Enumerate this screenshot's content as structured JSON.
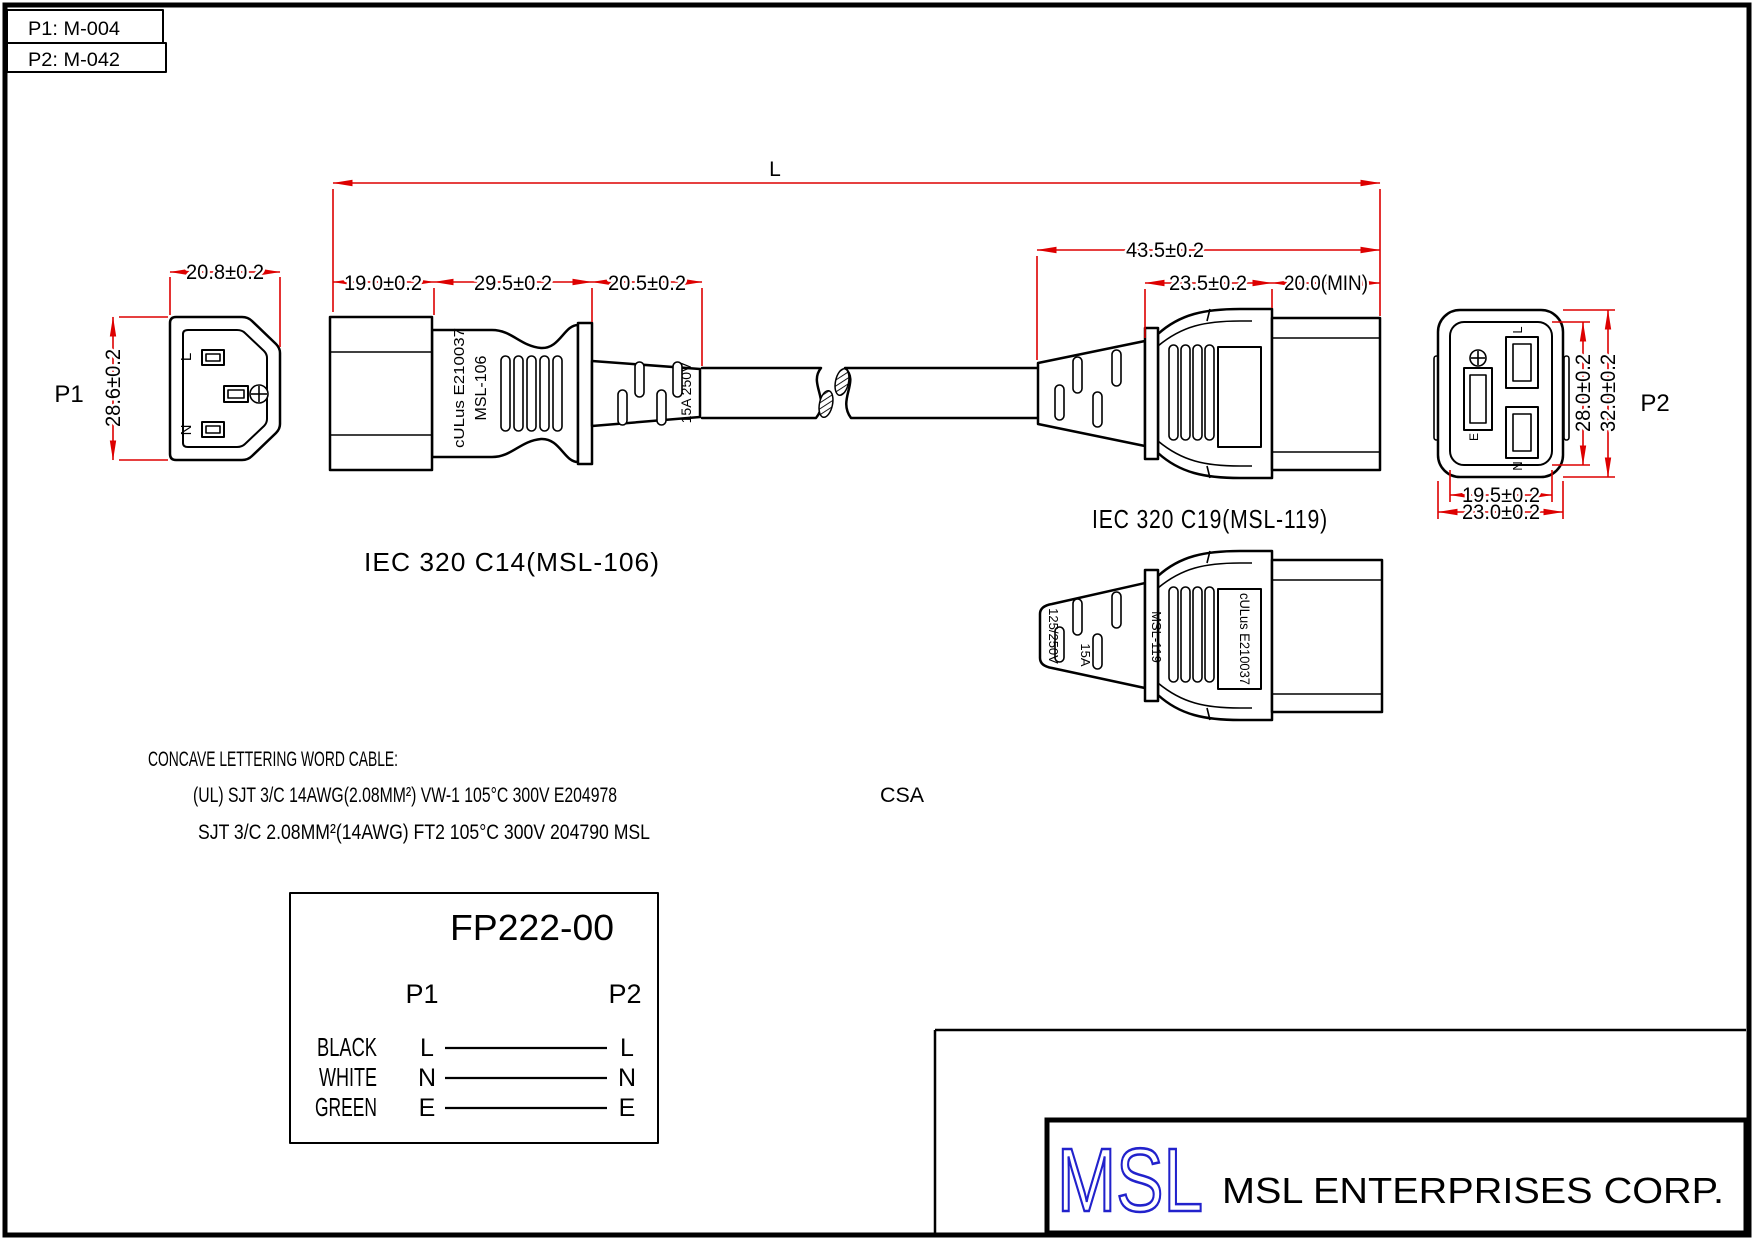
{
  "ref": {
    "p1": "P1: M-004",
    "p2": "P2: M-042"
  },
  "dims": {
    "L": "L",
    "d19": "19.0±0.2",
    "d295": "29.5±0.2",
    "d205": "20.5±0.2",
    "d208": "20.8±0.2",
    "d286": "28.6±0.2",
    "d435": "43.5±0.2",
    "d235": "23.5±0.2",
    "d20min": "20.0(MIN)",
    "d280": "28.0±0.2",
    "d320": "32.0±0.2",
    "d195": "19.5±0.2",
    "d230": "23.0±0.2"
  },
  "views": {
    "p1_label": "P1",
    "p2_label": "P2",
    "c14_caption": "IEC 320 C14(MSL-106)",
    "c19_caption": "IEC 320 C19(MSL-119)"
  },
  "pins": {
    "l": "L",
    "n": "N",
    "e": "E"
  },
  "molding": {
    "c14_ul": "cULus E210037",
    "c14_model": "MSL-106",
    "c14_rating": "15A 250V",
    "c19_rating_v": "125/250V",
    "c19_rating_a": "15A",
    "c19_model": "MSL-119",
    "c19_ul": "cULus E210037"
  },
  "cable_note": {
    "title": "CONCAVE LETTERING WORD CABLE:",
    "line1": "(UL) SJT 3/C 14AWG(2.08MM²) VW-1 105°C 300V E204978",
    "line1_csa": "CSA",
    "line2": "SJT 3/C 2.08MM²(14AWG) FT2 105°C 300V 204790 MSL"
  },
  "spec": {
    "part_number": "FP222-00",
    "col_p1": "P1",
    "col_p2": "P2",
    "rows": [
      {
        "color": "BLACK",
        "from": "L",
        "to": "L"
      },
      {
        "color": "WHITE",
        "from": "N",
        "to": "N"
      },
      {
        "color": "GREEN",
        "from": "E",
        "to": "E"
      }
    ]
  },
  "title_block": {
    "logo": "MSL",
    "company": "MSL ENTERPRISES CORP."
  },
  "colors": {
    "dimension_red": "#dd0000",
    "line_black": "#000000",
    "logo_blue": "#2222cc",
    "paper_white": "#ffffff"
  }
}
